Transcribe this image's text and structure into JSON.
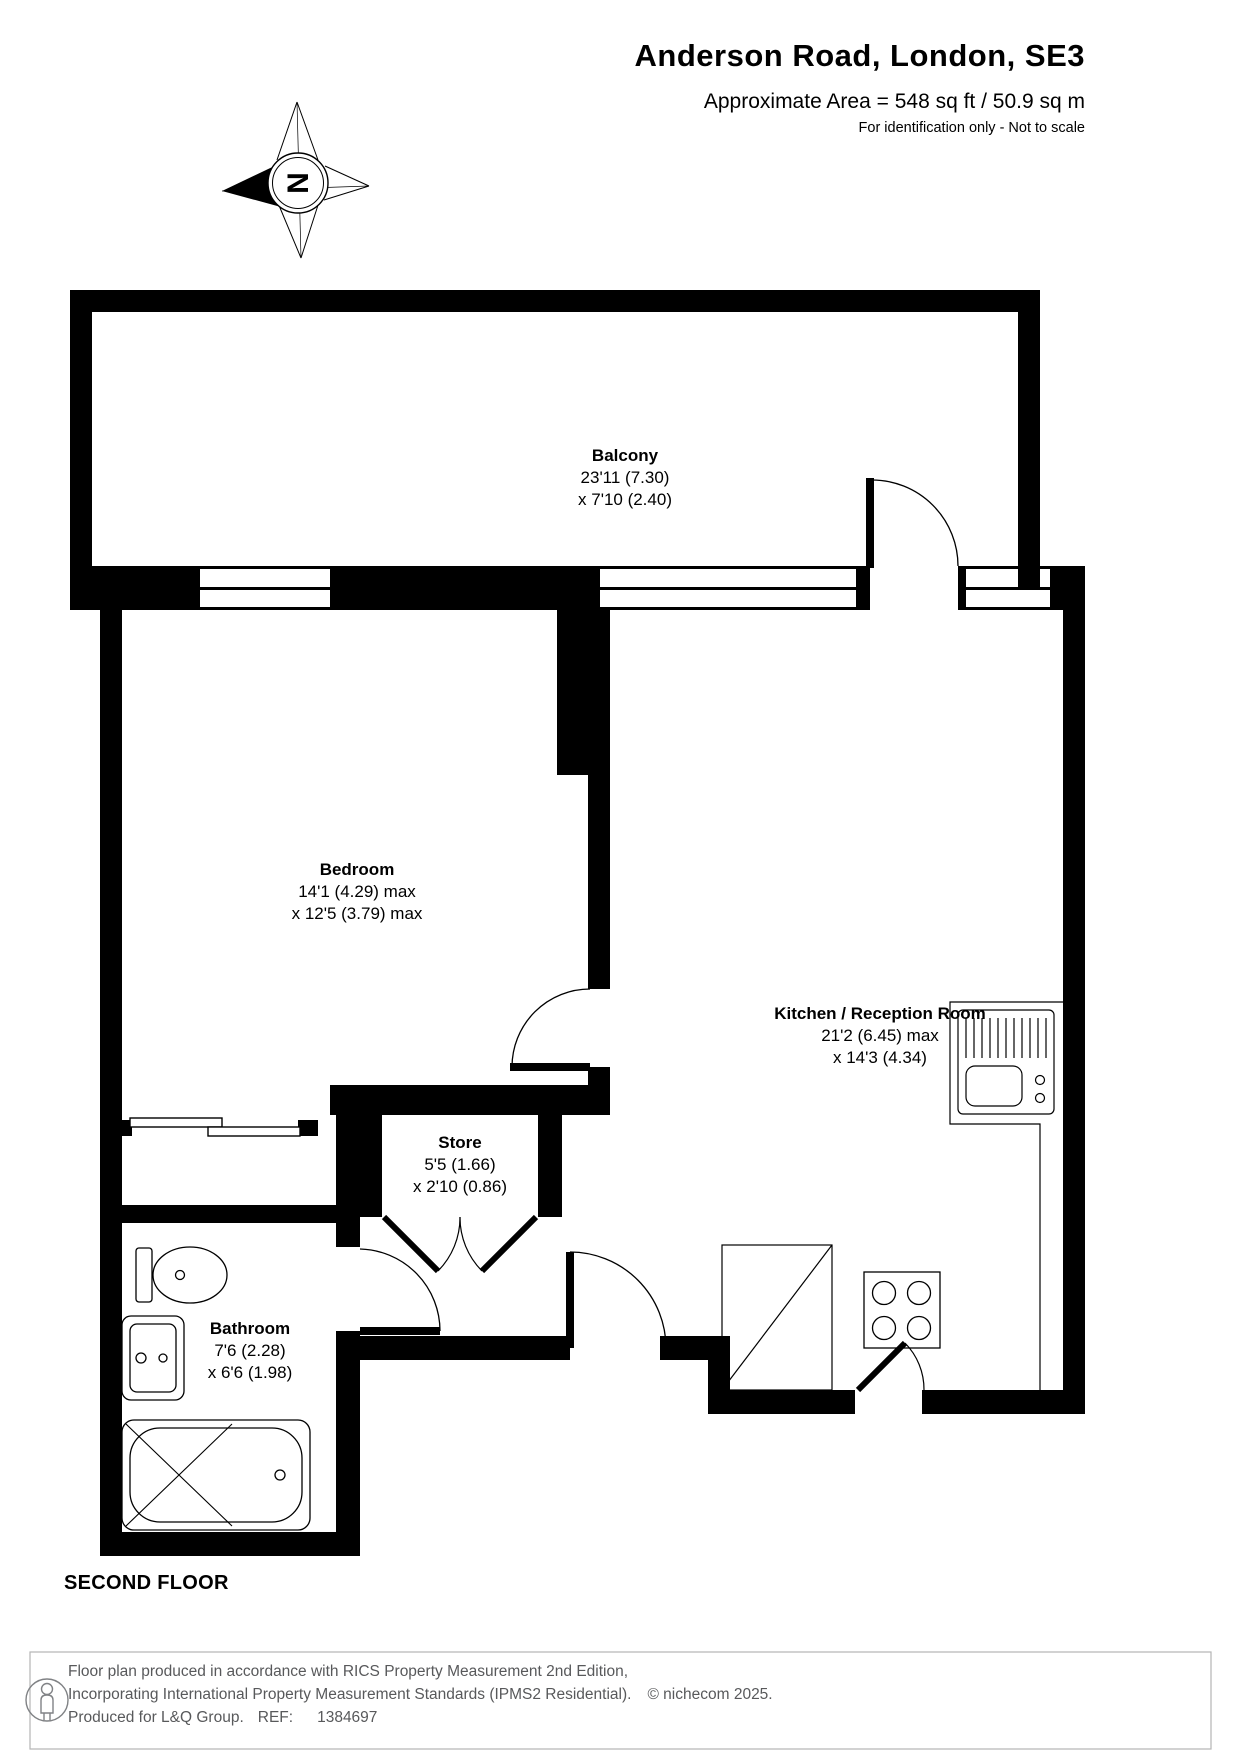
{
  "header": {
    "title": "Anderson Road, London, SE3",
    "area_line": "Approximate Area = 548 sq ft / 50.9 sq m",
    "note_line": "For identification only - Not to scale"
  },
  "compass": {
    "north_label": "N"
  },
  "plan": {
    "floor_label": "SECOND FLOOR",
    "rooms": [
      {
        "name": "Balcony",
        "dim1": "23'11 (7.30)",
        "dim2": "x 7'10 (2.40)"
      },
      {
        "name": "Bedroom",
        "dim1": "14'1 (4.29) max",
        "dim2": "x 12'5 (3.79) max"
      },
      {
        "name": "Kitchen / Reception Room",
        "dim1": "21'2 (6.45) max",
        "dim2": "x 14'3 (4.34)"
      },
      {
        "name": "Store",
        "dim1": "5'5 (1.66)",
        "dim2": "x 2'10 (0.86)"
      },
      {
        "name": "Bathroom",
        "dim1": "7'6 (2.28)",
        "dim2": "x 6'6 (1.98)"
      }
    ]
  },
  "footer": {
    "line1": "Floor plan produced in accordance with RICS Property Measurement 2nd Edition,",
    "line2": "Incorporating International Property Measurement Standards (IPMS2 Residential).",
    "copyright": "© nichecom 2025.",
    "produced_for": "Produced for L&Q Group.",
    "ref_label": "REF:",
    "ref_value": "1384697"
  },
  "colors": {
    "wall": "#000000",
    "text": "#000000",
    "footer_text": "#58595b"
  }
}
